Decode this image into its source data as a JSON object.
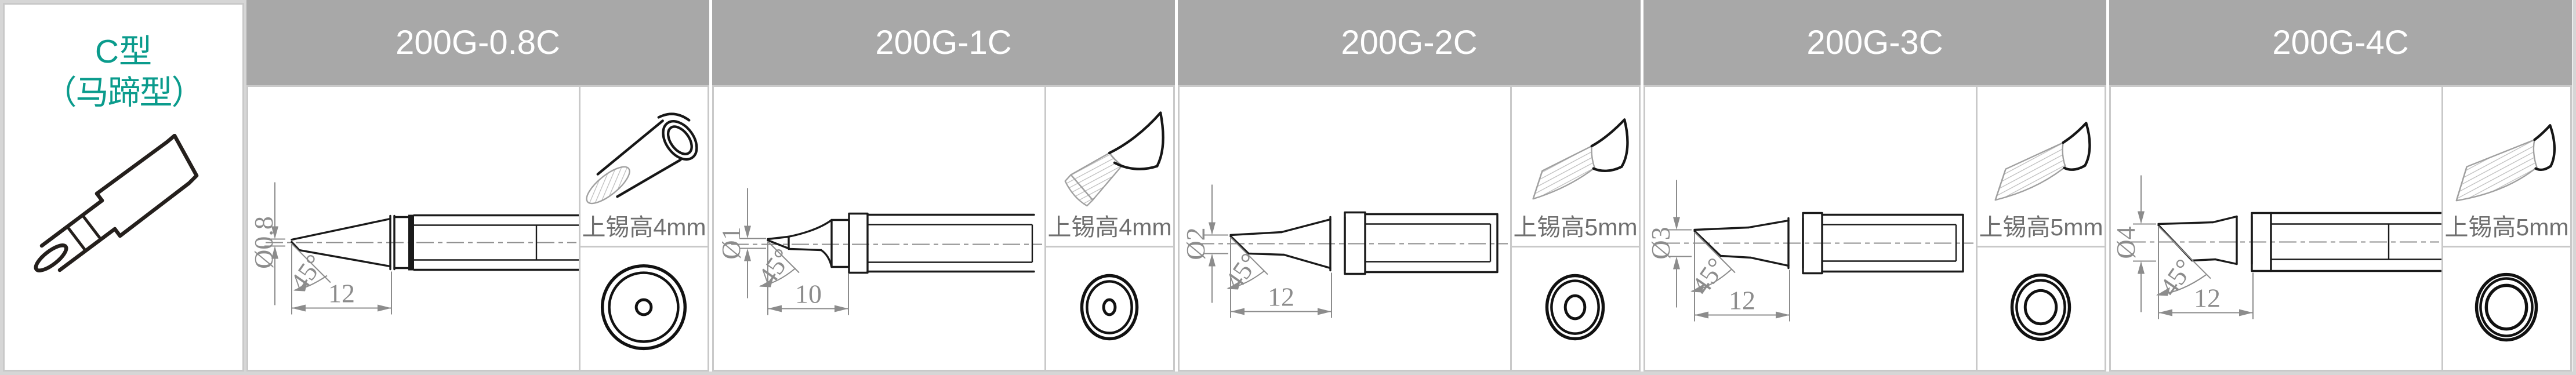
{
  "category": {
    "title_line1": "C型",
    "title_line2": "（马蹄型）"
  },
  "products": [
    {
      "model": "200G-0.8C",
      "diameter": "Ø0.8",
      "angle": "45°",
      "length": "12",
      "tin_height": "上锡高4mm"
    },
    {
      "model": "200G-1C",
      "diameter": "Ø1",
      "angle": "45°",
      "length": "10",
      "tin_height": "上锡高4mm"
    },
    {
      "model": "200G-2C",
      "diameter": "Ø2",
      "angle": "45°",
      "length": "12",
      "tin_height": "上锡高5mm"
    },
    {
      "model": "200G-3C",
      "diameter": "Ø3",
      "angle": "45°",
      "length": "12",
      "tin_height": "上锡高5mm"
    },
    {
      "model": "200G-4C",
      "diameter": "Ø4",
      "angle": "45°",
      "length": "12",
      "tin_height": "上锡高5mm"
    }
  ],
  "colors": {
    "accent_teal": "#0a9b8c",
    "header_bg": "#a8a8a8",
    "header_text": "#ffffff",
    "grid_line": "#c9c9c9",
    "page_background": "#d6d6d6",
    "dimension_gray": "#8c8c8c",
    "caption_gray": "#6f6f6f"
  }
}
